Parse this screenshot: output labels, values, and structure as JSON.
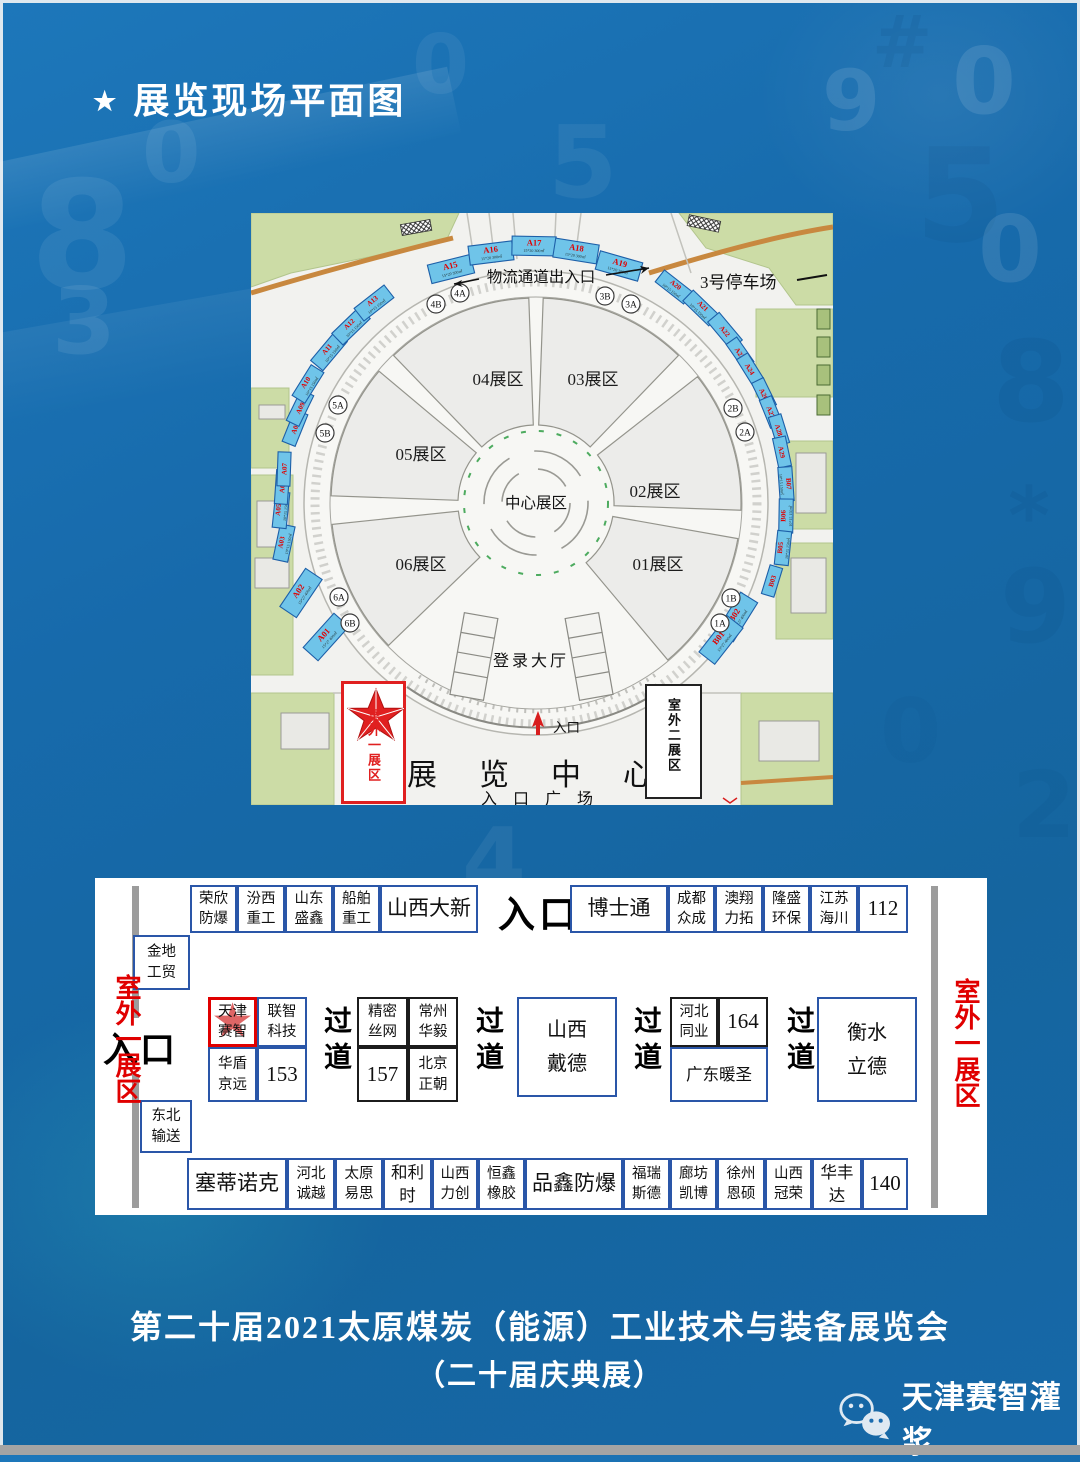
{
  "page": {
    "title_star": "★",
    "title": "展览现场平面图",
    "footer_line1": "第二十届2021太原煤炭（能源）工业技术与装备展览会",
    "footer_line2": "（二十届庆典展）",
    "wechat_name": "天津赛智灌浆"
  },
  "colors": {
    "booth_fill": "#6fc4e9",
    "booth_stroke": "#1d5fa8",
    "red": "#e00000",
    "table_border": "#2a56a8",
    "background_blue": "#1668a8",
    "map_green": "#ccdca6",
    "road_orange": "#c8883f"
  },
  "map": {
    "logistics_label": "物流通道出入口",
    "parking_label": "3号停车场",
    "center_zone": "中心展区",
    "login_hall": "登录大厅",
    "entrance": "入口",
    "exhibition_center": "展览中心",
    "entrance_plaza": "入口广场",
    "outdoor_area1": "室外一展区",
    "outdoor_area2": "室外二展区",
    "zones": [
      {
        "label": "04展区",
        "x": 247,
        "y": 172
      },
      {
        "label": "03展区",
        "x": 342,
        "y": 172
      },
      {
        "label": "05展区",
        "x": 170,
        "y": 247
      },
      {
        "label": "02展区",
        "x": 404,
        "y": 284
      },
      {
        "label": "06展区",
        "x": 170,
        "y": 357
      },
      {
        "label": "01展区",
        "x": 407,
        "y": 357
      }
    ],
    "gates": [
      {
        "id": "4B",
        "x": 185,
        "y": 91
      },
      {
        "id": "4A",
        "x": 209,
        "y": 80
      },
      {
        "id": "3B",
        "x": 354,
        "y": 83
      },
      {
        "id": "3A",
        "x": 380,
        "y": 91
      },
      {
        "id": "5A",
        "x": 87,
        "y": 192
      },
      {
        "id": "5B",
        "x": 74,
        "y": 220
      },
      {
        "id": "2B",
        "x": 482,
        "y": 195
      },
      {
        "id": "2A",
        "x": 494,
        "y": 219
      },
      {
        "id": "6A",
        "x": 88,
        "y": 384
      },
      {
        "id": "6B",
        "x": 99,
        "y": 410
      },
      {
        "id": "1B",
        "x": 480,
        "y": 385
      },
      {
        "id": "1A",
        "x": 469,
        "y": 410
      }
    ],
    "booths": [
      {
        "id": "A01",
        "x": 75,
        "y": 424,
        "r": -48,
        "w": 46,
        "h": 20,
        "size": "15*27 400㎡"
      },
      {
        "id": "A02",
        "x": 50,
        "y": 380,
        "r": -56,
        "w": 46,
        "h": 20,
        "size": "15*27 400㎡"
      },
      {
        "id": "A03",
        "x": 33,
        "y": 330,
        "r": -78,
        "w": 36,
        "h": 15,
        "size": "10*15 150㎡"
      },
      {
        "id": "A05",
        "x": 30,
        "y": 297,
        "r": -84,
        "w": 36,
        "h": 14,
        "size": "10*15 150㎡"
      },
      {
        "id": "A06",
        "x": 31,
        "y": 274,
        "r": -86,
        "w": 34,
        "h": 13,
        "size": ""
      },
      {
        "id": "A07",
        "x": 33,
        "y": 256,
        "r": -88,
        "w": 34,
        "h": 13,
        "size": ""
      },
      {
        "id": "A08",
        "x": 44,
        "y": 215,
        "r": -68,
        "w": 34,
        "h": 14,
        "size": ""
      },
      {
        "id": "A09",
        "x": 49,
        "y": 195,
        "r": -64,
        "w": 34,
        "h": 14,
        "size": ""
      },
      {
        "id": "A10",
        "x": 57,
        "y": 171,
        "r": -58,
        "w": 36,
        "h": 15,
        "size": "10*15 150㎡"
      },
      {
        "id": "A11",
        "x": 78,
        "y": 138,
        "r": -50,
        "w": 38,
        "h": 16,
        "size": "10*15 150㎡"
      },
      {
        "id": "A12",
        "x": 100,
        "y": 113,
        "r": -44,
        "w": 38,
        "h": 16,
        "size": "10*15 150㎡"
      },
      {
        "id": "A13",
        "x": 123,
        "y": 90,
        "r": -38,
        "w": 38,
        "h": 16,
        "size": "10*15 150㎡"
      },
      {
        "id": "A15",
        "x": 200,
        "y": 56,
        "r": -14,
        "w": 44,
        "h": 19,
        "size": "15*20 300㎡"
      },
      {
        "id": "A16",
        "x": 240,
        "y": 40,
        "r": -7,
        "w": 44,
        "h": 19,
        "size": "15*20 300㎡"
      },
      {
        "id": "A17",
        "x": 283,
        "y": 33,
        "r": 1,
        "w": 44,
        "h": 19,
        "size": "15*20 300㎡"
      },
      {
        "id": "A18",
        "x": 325,
        "y": 38,
        "r": 9,
        "w": 44,
        "h": 19,
        "size": "15*20 300㎡"
      },
      {
        "id": "A19",
        "x": 368,
        "y": 53,
        "r": 16,
        "w": 44,
        "h": 19,
        "size": "15*20 300㎡"
      },
      {
        "id": "A20",
        "x": 423,
        "y": 74,
        "r": 38,
        "w": 36,
        "h": 15,
        "size": "10*15 150㎡"
      },
      {
        "id": "A21",
        "x": 450,
        "y": 95,
        "r": 44,
        "w": 36,
        "h": 15,
        "size": "10*15 150㎡"
      },
      {
        "id": "A22",
        "x": 474,
        "y": 118,
        "r": 50,
        "w": 36,
        "h": 15,
        "size": ""
      },
      {
        "id": "A23",
        "x": 489,
        "y": 140,
        "r": 55,
        "w": 30,
        "h": 13,
        "size": ""
      },
      {
        "id": "A24",
        "x": 499,
        "y": 156,
        "r": 58,
        "w": 30,
        "h": 13,
        "size": ""
      },
      {
        "id": "A26",
        "x": 513,
        "y": 181,
        "r": 64,
        "w": 30,
        "h": 13,
        "size": ""
      },
      {
        "id": "A27",
        "x": 520,
        "y": 199,
        "r": 68,
        "w": 30,
        "h": 13,
        "size": ""
      },
      {
        "id": "A28",
        "x": 528,
        "y": 217,
        "r": 73,
        "w": 30,
        "h": 13,
        "size": ""
      },
      {
        "id": "A29",
        "x": 531,
        "y": 239,
        "r": 78,
        "w": 30,
        "h": 13,
        "size": ""
      },
      {
        "id": "B07",
        "x": 535,
        "y": 271,
        "r": 86,
        "w": 34,
        "h": 14,
        "size": "10*15 150㎡"
      },
      {
        "id": "B06",
        "x": 535,
        "y": 303,
        "r": -89,
        "w": 34,
        "h": 14,
        "size": "10*15 150㎡"
      },
      {
        "id": "B05",
        "x": 532,
        "y": 335,
        "r": -84,
        "w": 34,
        "h": 14,
        "size": "10*15 150㎡"
      },
      {
        "id": "B03",
        "x": 521,
        "y": 368,
        "r": -73,
        "w": 30,
        "h": 13,
        "size": ""
      },
      {
        "id": "B02",
        "x": 486,
        "y": 404,
        "r": -58,
        "w": 46,
        "h": 20,
        "size": "15*27 400㎡"
      },
      {
        "id": "B01",
        "x": 470,
        "y": 427,
        "r": -52,
        "w": 46,
        "h": 20,
        "size": "15*27 400㎡"
      }
    ]
  },
  "table": {
    "entrance_top": "入口",
    "entrance_left": "入口",
    "outdoor_left": "室外一展区",
    "outdoor_right": "室外一展区",
    "aisle": "过道",
    "aisles": [
      {
        "x": 220
      },
      {
        "x": 372
      },
      {
        "x": 530
      },
      {
        "x": 683
      }
    ],
    "cells": [
      {
        "label": "荣欣防爆",
        "x": 95,
        "y": 7,
        "w": 47,
        "h": 48,
        "s": "m"
      },
      {
        "label": "汾西重工",
        "x": 142,
        "y": 7,
        "w": 48,
        "h": 48,
        "s": "m"
      },
      {
        "label": "山东盛鑫",
        "x": 190,
        "y": 7,
        "w": 48,
        "h": 48,
        "s": "m"
      },
      {
        "label": "船舶重工",
        "x": 238,
        "y": 7,
        "w": 47,
        "h": 48,
        "s": "m"
      },
      {
        "label": "山西大新",
        "x": 285,
        "y": 7,
        "w": 98,
        "h": 48,
        "s": "xl"
      },
      {
        "label": "博士通",
        "x": 475,
        "y": 7,
        "w": 98,
        "h": 48,
        "s": "xl"
      },
      {
        "label": "成都众成",
        "x": 573,
        "y": 7,
        "w": 47,
        "h": 48,
        "s": "m"
      },
      {
        "label": "澳翔力拓",
        "x": 620,
        "y": 7,
        "w": 48,
        "h": 48,
        "s": "m"
      },
      {
        "label": "隆盛环保",
        "x": 668,
        "y": 7,
        "w": 47,
        "h": 48,
        "s": "m"
      },
      {
        "label": "江苏海川",
        "x": 715,
        "y": 7,
        "w": 48,
        "h": 48,
        "s": "m"
      },
      {
        "label": "112",
        "x": 763,
        "y": 7,
        "w": 50,
        "h": 48,
        "s": "xl"
      },
      {
        "label": "金地工贸",
        "x": 38,
        "y": 57,
        "w": 57,
        "h": 55,
        "s": "m"
      },
      {
        "label": "天津赛智",
        "x": 113,
        "y": 119,
        "w": 49,
        "h": 50,
        "s": "m",
        "cls": "red-cell"
      },
      {
        "label": "联智科技",
        "x": 162,
        "y": 119,
        "w": 50,
        "h": 50,
        "s": "m"
      },
      {
        "label": "华盾京远",
        "x": 113,
        "y": 169,
        "w": 49,
        "h": 55,
        "s": "m"
      },
      {
        "label": "153",
        "x": 162,
        "y": 169,
        "w": 50,
        "h": 55,
        "s": "xl"
      },
      {
        "label": "精密丝网",
        "x": 262,
        "y": 119,
        "w": 51,
        "h": 50,
        "s": "m",
        "cls": "dark"
      },
      {
        "label": "常州华毅",
        "x": 313,
        "y": 119,
        "w": 50,
        "h": 50,
        "s": "m",
        "cls": "dark"
      },
      {
        "label": "157",
        "x": 262,
        "y": 169,
        "w": 51,
        "h": 55,
        "s": "xl",
        "cls": "dark"
      },
      {
        "label": "北京正朝",
        "x": 313,
        "y": 169,
        "w": 50,
        "h": 55,
        "s": "m",
        "cls": "dark"
      },
      {
        "label": "山西戴德",
        "x": 422,
        "y": 119,
        "w": 100,
        "h": 100,
        "s": "xl2"
      },
      {
        "label": "河北同业",
        "x": 575,
        "y": 119,
        "w": 48,
        "h": 50,
        "s": "m",
        "cls": "dark"
      },
      {
        "label": "164",
        "x": 623,
        "y": 119,
        "w": 50,
        "h": 50,
        "s": "xl",
        "cls": "dark"
      },
      {
        "label": "广东暖圣",
        "x": 575,
        "y": 169,
        "w": 98,
        "h": 55,
        "s": "l"
      },
      {
        "label": "衡水立德",
        "x": 722,
        "y": 119,
        "w": 100,
        "h": 105,
        "s": "xl2"
      },
      {
        "label": "东北输送",
        "x": 45,
        "y": 222,
        "w": 52,
        "h": 53,
        "s": "m"
      },
      {
        "label": "塞蒂诺克",
        "x": 92,
        "y": 280,
        "w": 100,
        "h": 52,
        "s": "xl"
      },
      {
        "label": "河北诚越",
        "x": 192,
        "y": 280,
        "w": 48,
        "h": 52,
        "s": "m"
      },
      {
        "label": "太原易思",
        "x": 240,
        "y": 280,
        "w": 48,
        "h": 52,
        "s": "m"
      },
      {
        "label": "和利时",
        "x": 288,
        "y": 280,
        "w": 49,
        "h": 52,
        "s": "l"
      },
      {
        "label": "山西力创",
        "x": 337,
        "y": 280,
        "w": 46,
        "h": 52,
        "s": "m"
      },
      {
        "label": "恒鑫橡胶",
        "x": 383,
        "y": 280,
        "w": 47,
        "h": 52,
        "s": "m"
      },
      {
        "label": "品鑫防爆",
        "x": 430,
        "y": 280,
        "w": 98,
        "h": 52,
        "s": "xl"
      },
      {
        "label": "福瑞斯德",
        "x": 528,
        "y": 280,
        "w": 47,
        "h": 52,
        "s": "m"
      },
      {
        "label": "廊坊凯博",
        "x": 575,
        "y": 280,
        "w": 47,
        "h": 52,
        "s": "m"
      },
      {
        "label": "徐州恩硕",
        "x": 622,
        "y": 280,
        "w": 48,
        "h": 52,
        "s": "m"
      },
      {
        "label": "山西冠荣",
        "x": 670,
        "y": 280,
        "w": 47,
        "h": 52,
        "s": "m"
      },
      {
        "label": "华丰达",
        "x": 717,
        "y": 280,
        "w": 50,
        "h": 52,
        "s": "l"
      },
      {
        "label": "140",
        "x": 767,
        "y": 280,
        "w": 46,
        "h": 52,
        "s": "xl"
      }
    ]
  },
  "background": {
    "glyphs": [
      {
        "ch": "#",
        "x": 872,
        "y": 0,
        "s": 72,
        "o": 0.16,
        "c": "dark"
      },
      {
        "ch": "5",
        "x": 915,
        "y": 120,
        "s": 130,
        "o": 0.12,
        "c": "dark"
      },
      {
        "ch": "9",
        "x": 822,
        "y": 52,
        "s": 84,
        "o": 0.1,
        "c": "light"
      },
      {
        "ch": "0",
        "x": 952,
        "y": 28,
        "s": 92,
        "o": 0.1,
        "c": "light"
      },
      {
        "ch": "0",
        "x": 978,
        "y": 196,
        "s": 92,
        "o": 0.1,
        "c": "light"
      },
      {
        "ch": "8",
        "x": 992,
        "y": 318,
        "s": 112,
        "o": 0.13,
        "c": "dark"
      },
      {
        "ch": "*",
        "x": 1008,
        "y": 470,
        "s": 80,
        "o": 0.15,
        "c": "dark"
      },
      {
        "ch": "9",
        "x": 1000,
        "y": 548,
        "s": 102,
        "o": 0.12,
        "c": "dark"
      },
      {
        "ch": "2",
        "x": 1012,
        "y": 752,
        "s": 92,
        "o": 0.1,
        "c": "dark"
      },
      {
        "ch": "8",
        "x": 30,
        "y": 150,
        "s": 150,
        "o": 0.07,
        "c": "light"
      },
      {
        "ch": "3",
        "x": 52,
        "y": 268,
        "s": 92,
        "o": 0.08,
        "c": "light"
      },
      {
        "ch": "0",
        "x": 142,
        "y": 104,
        "s": 84,
        "o": 0.07,
        "c": "light"
      },
      {
        "ch": "0",
        "x": 412,
        "y": 18,
        "s": 82,
        "o": 0.06,
        "c": "light"
      },
      {
        "ch": "5",
        "x": 548,
        "y": 104,
        "s": 100,
        "o": 0.06,
        "c": "light"
      },
      {
        "ch": "4",
        "x": 462,
        "y": 808,
        "s": 92,
        "o": 0.06,
        "c": "light"
      },
      {
        "ch": "0",
        "x": 880,
        "y": 680,
        "s": 88,
        "o": 0.08,
        "c": "dark"
      }
    ]
  }
}
